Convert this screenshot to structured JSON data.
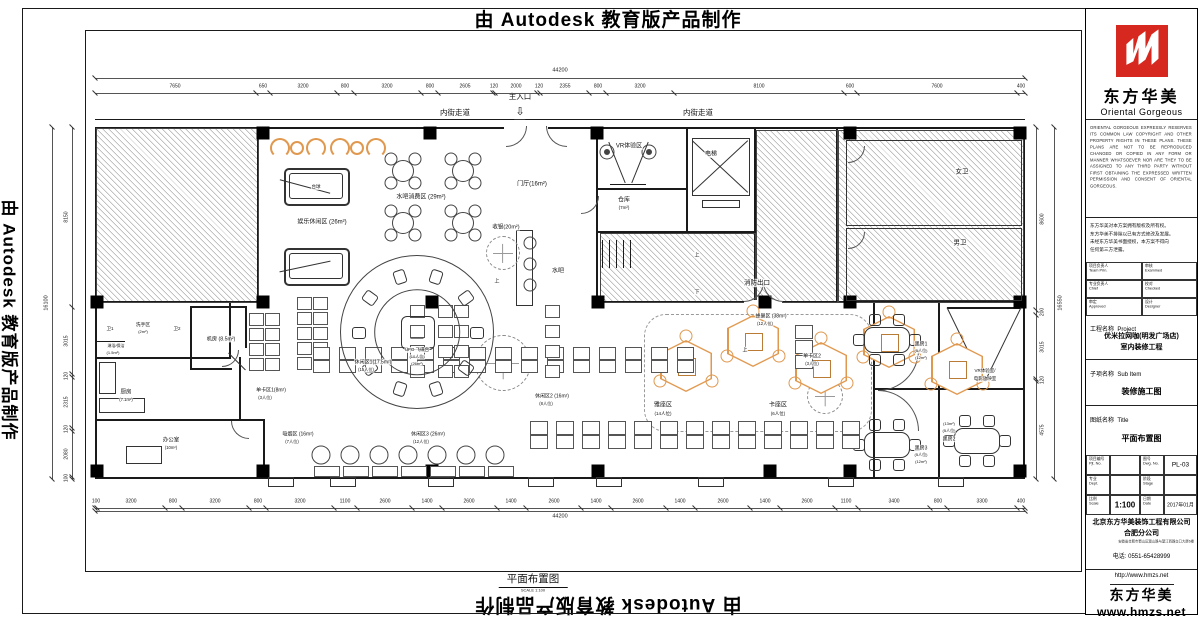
{
  "watermark": {
    "text": "由 Autodesk 教育版产品制作"
  },
  "sheet": {
    "footer_title": "平面布置图",
    "footer_scale": "SCALE  1:100"
  },
  "plan": {
    "labels": [
      [
        "内街走道",
        455,
        113,
        7.5
      ],
      [
        "主入口",
        520,
        97,
        7.5
      ],
      [
        "内街走道",
        698,
        113,
        7.5
      ],
      [
        "⇩",
        520,
        112,
        11
      ],
      [
        "娱乐休闲区 (26m²)",
        322,
        222,
        6
      ],
      [
        "台球",
        316,
        187,
        4.5
      ],
      [
        "水吧消费区 (29m²)",
        421,
        197,
        6
      ],
      [
        "门厅(16m²)",
        532,
        184,
        6
      ],
      [
        "VR体验区",
        629,
        146,
        6
      ],
      [
        "仓库",
        624,
        200,
        6
      ],
      [
        "(7m²)",
        624,
        208,
        4.5
      ],
      [
        "电梯",
        711,
        154,
        6
      ],
      [
        "女卫",
        962,
        172,
        6.5
      ],
      [
        "男卫",
        960,
        243,
        6.5
      ],
      [
        "消防出口",
        757,
        283,
        6.5
      ],
      [
        "收银(20m²)",
        506,
        227,
        5.5
      ],
      [
        "水吧",
        558,
        271,
        6
      ],
      [
        "机房 (8.5m²)",
        221,
        339,
        5.2
      ],
      [
        "洗手区",
        143,
        325,
        4.8
      ],
      [
        "(2m²)",
        143,
        332,
        4
      ],
      [
        "卫1",
        110,
        329,
        4.5
      ],
      [
        "卫2",
        177,
        329,
        4.5
      ],
      [
        "淋浴/保洁",
        116,
        346,
        4
      ],
      [
        "(1.5m²)",
        113,
        353,
        4
      ],
      [
        "厨房",
        126,
        392,
        5.5
      ],
      [
        "(7.1m²)",
        126,
        400,
        4.2
      ],
      [
        "办公室",
        171,
        440,
        5.5
      ],
      [
        "(10m²)",
        171,
        448,
        4.2
      ],
      [
        "单卡区1(8m²)",
        271,
        390,
        5
      ],
      [
        "(3人位)",
        265,
        398,
        4.2
      ],
      [
        "吸烟区 (16m²)",
        298,
        434,
        5
      ],
      [
        "(7人位)",
        292,
        442,
        4.2
      ],
      [
        "休闲区1(17.5m²)",
        373,
        362,
        5
      ],
      [
        "(15人位)",
        366,
        370,
        4.2
      ],
      [
        "休闲区2 (16m²)",
        552,
        396,
        5
      ],
      [
        "(8人位)",
        546,
        404,
        4.2
      ],
      [
        "休闲区3 (26m²)",
        428,
        434,
        5
      ],
      [
        "(12人位)",
        421,
        442,
        4.2
      ],
      [
        "雅座区",
        663,
        405,
        6
      ],
      [
        "(14人位)",
        663,
        414,
        4.5
      ],
      [
        "蜂巢区 (38m²)",
        771,
        316,
        5
      ],
      [
        "(12人位)",
        765,
        324,
        4.2
      ],
      [
        "单卡区2",
        812,
        356,
        5
      ],
      [
        "(3人位)",
        812,
        364,
        4.2
      ],
      [
        "卡座区",
        778,
        405,
        6
      ],
      [
        "(6人位)",
        778,
        414,
        4.5
      ],
      [
        "黑房1",
        921,
        344,
        5
      ],
      [
        "(5人位)",
        921,
        351,
        4
      ],
      [
        "(12m²)",
        921,
        358,
        4
      ],
      [
        "黑房3",
        921,
        448,
        5
      ],
      [
        "(5人位)",
        921,
        455,
        4
      ],
      [
        "(12m²)",
        921,
        462,
        4
      ],
      [
        "(13m²)",
        949,
        424,
        4
      ],
      [
        "(5人位)",
        949,
        431,
        4
      ],
      [
        "黑房2",
        949,
        439,
        5
      ],
      [
        "VR体验室/",
        985,
        371,
        4.5
      ],
      [
        "电影放映室",
        985,
        379,
        4.5
      ],
      [
        "UFO 飞碟台",
        417,
        350,
        4.5
      ],
      [
        "(10人位)",
        417,
        357,
        4
      ],
      [
        "(26m²)",
        417,
        364,
        4
      ],
      [
        "上",
        497,
        281,
        5
      ],
      [
        "上",
        697,
        255,
        5
      ],
      [
        "下",
        697,
        292,
        5
      ],
      [
        "上",
        745,
        350,
        5
      ]
    ],
    "dims": {
      "top": {
        "total": "44200",
        "segments": [
          7650,
          650,
          3200,
          800,
          3200,
          800,
          2605,
          120,
          2000,
          120,
          2355,
          800,
          3200,
          8100,
          600,
          7600,
          400
        ]
      },
      "bottom": {
        "total": "44200",
        "segments": [
          100,
          3200,
          800,
          3200,
          800,
          3200,
          1100,
          2600,
          1400,
          2600,
          1400,
          2600,
          1400,
          2600,
          1400,
          2600,
          1400,
          2600,
          1100,
          3400,
          800,
          3300,
          400
        ]
      },
      "left": {
        "total": "16100",
        "segments": [
          8150,
          3015,
          120,
          2315,
          120,
          2080,
          100
        ]
      },
      "right": {
        "total": "16550",
        "segments": [
          8600,
          200,
          3015,
          120,
          4575
        ]
      }
    },
    "walls": [
      [
        95,
        119,
        930,
        1
      ],
      [
        95,
        127,
        930,
        2
      ],
      [
        95,
        477,
        930,
        2
      ],
      [
        95,
        127,
        2,
        352
      ],
      [
        1023,
        127,
        2,
        352
      ],
      [
        257,
        127,
        2,
        175
      ],
      [
        95,
        301,
        170,
        2
      ],
      [
        95,
        357,
        136,
        2
      ],
      [
        95,
        419,
        170,
        2
      ],
      [
        229,
        301,
        2,
        57
      ],
      [
        239,
        357,
        2,
        62
      ],
      [
        263,
        419,
        2,
        60
      ],
      [
        190,
        306,
        57,
        2
      ],
      [
        190,
        306,
        2,
        64
      ],
      [
        190,
        368,
        42,
        2
      ],
      [
        245,
        306,
        2,
        42
      ],
      [
        596,
        127,
        2,
        178
      ],
      [
        598,
        188,
        90,
        2
      ],
      [
        598,
        231,
        156,
        2
      ],
      [
        686,
        127,
        2,
        104
      ],
      [
        754,
        129,
        2,
        172
      ],
      [
        836,
        129,
        2,
        172
      ],
      [
        598,
        301,
        148,
        2
      ],
      [
        782,
        301,
        241,
        2
      ],
      [
        873,
        303,
        2,
        174
      ],
      [
        938,
        303,
        2,
        174
      ],
      [
        875,
        388,
        148,
        2
      ],
      [
        947,
        307,
        74,
        2
      ],
      [
        602,
        240,
        1,
        28
      ],
      [
        609,
        240,
        1,
        28
      ],
      [
        616,
        240,
        1,
        28
      ],
      [
        623,
        240,
        1,
        28
      ],
      [
        630,
        240,
        1,
        28
      ],
      [
        95,
        341,
        30,
        1
      ],
      [
        610,
        184,
        36,
        1
      ]
    ],
    "white_rects": [
      [
        504,
        124,
        44,
        6
      ],
      [
        744,
        300,
        38,
        4
      ]
    ],
    "hatches": [
      [
        96,
        128,
        161,
        173
      ],
      [
        756,
        130,
        80,
        171
      ],
      [
        838,
        130,
        184,
        171
      ],
      [
        600,
        233,
        154,
        68
      ]
    ],
    "columns": [
      [
        263,
        133
      ],
      [
        430,
        133
      ],
      [
        597,
        133
      ],
      [
        850,
        133
      ],
      [
        1020,
        133
      ],
      [
        97,
        302
      ],
      [
        263,
        302
      ],
      [
        432,
        302
      ],
      [
        598,
        302
      ],
      [
        765,
        302
      ],
      [
        850,
        302
      ],
      [
        1020,
        302
      ],
      [
        97,
        471
      ],
      [
        263,
        471
      ],
      [
        432,
        471
      ],
      [
        598,
        471
      ],
      [
        770,
        471
      ],
      [
        850,
        471
      ],
      [
        1020,
        471
      ],
      [
        417,
        332
      ]
    ],
    "boxes": [
      [
        692,
        138,
        56,
        56
      ],
      [
        702,
        200,
        36,
        6
      ],
      [
        846,
        140,
        174,
        84
      ],
      [
        846,
        228,
        174,
        71
      ],
      [
        516,
        230,
        15,
        74
      ],
      [
        99,
        362,
        15,
        30
      ],
      [
        99,
        398,
        44,
        13
      ],
      [
        126,
        446,
        34,
        16
      ],
      [
        268,
        477,
        24,
        8
      ],
      [
        330,
        477,
        24,
        8
      ],
      [
        428,
        477,
        24,
        8
      ],
      [
        528,
        477,
        24,
        8
      ],
      [
        596,
        477,
        24,
        8
      ],
      [
        698,
        477,
        24,
        8
      ],
      [
        828,
        477,
        24,
        8
      ],
      [
        938,
        477,
        24,
        8
      ]
    ],
    "doors": [
      [
        506,
        126,
        20,
        "br"
      ],
      [
        546,
        126,
        20,
        "bl"
      ],
      [
        744,
        282,
        19,
        "br"
      ],
      [
        763,
        282,
        19,
        "bl"
      ],
      [
        581,
        196,
        17,
        "br"
      ],
      [
        222,
        350,
        16,
        "br"
      ],
      [
        231,
        421,
        17,
        "bl"
      ],
      [
        848,
        146,
        16,
        "br"
      ],
      [
        848,
        232,
        16,
        "br"
      ],
      [
        878,
        350,
        40,
        "br"
      ],
      [
        878,
        390,
        40,
        "tr"
      ]
    ],
    "diags": [
      [
        720,
        166,
        76,
        43
      ],
      [
        720,
        166,
        76,
        -43
      ],
      [
        617,
        162,
        44,
        68
      ],
      [
        640,
        162,
        44,
        -68
      ],
      [
        965,
        344,
        82,
        64
      ],
      [
        1003,
        344,
        82,
        -64
      ],
      [
        305,
        186,
        52,
        15
      ],
      [
        305,
        266,
        52,
        -12
      ],
      [
        237,
        361,
        24,
        45
      ]
    ],
    "dashed_circles": [
      [
        503,
        253,
        16
      ],
      [
        503,
        363,
        27
      ],
      [
        825,
        396,
        17
      ]
    ],
    "dashed_rect": [
      644,
      314,
      226,
      116
    ],
    "pool_tables": [
      [
        284,
        168
      ],
      [
        284,
        248
      ]
    ],
    "round_tables": [
      [
        403,
        171
      ],
      [
        463,
        171
      ],
      [
        403,
        223
      ],
      [
        463,
        223
      ]
    ],
    "hexpods": [
      [
        686,
        366
      ],
      [
        753,
        341
      ],
      [
        821,
        368
      ],
      [
        889,
        342
      ],
      [
        957,
        369
      ]
    ],
    "dark_tables": [
      [
        886,
        339
      ],
      [
        886,
        444
      ],
      [
        976,
        440
      ]
    ],
    "stools": [
      [
        530,
        243
      ],
      [
        530,
        264
      ],
      [
        530,
        285
      ]
    ],
    "lounge_chairs": [
      [
        321,
        455
      ],
      [
        350,
        455
      ],
      [
        379,
        455
      ],
      [
        408,
        455
      ],
      [
        437,
        455
      ],
      [
        466,
        455
      ],
      [
        495,
        455
      ]
    ],
    "vr_circles": [
      [
        607,
        152
      ],
      [
        649,
        152
      ]
    ],
    "sofa_groups": [
      270,
      330
    ],
    "desk_groups": [
      [
        249,
        313,
        4,
        2,
        13,
        11,
        16,
        15
      ],
      [
        297,
        297,
        5,
        2,
        13,
        11,
        16,
        15
      ],
      [
        313,
        347,
        2,
        15,
        15,
        11,
        26,
        13
      ],
      [
        410,
        305,
        4,
        1,
        13,
        11,
        0,
        20
      ],
      [
        438,
        305,
        4,
        2,
        13,
        11,
        16,
        20
      ],
      [
        545,
        305,
        4,
        1,
        13,
        11,
        0,
        20
      ],
      [
        530,
        421,
        2,
        13,
        16,
        12,
        26,
        14
      ],
      [
        314,
        466,
        1,
        7,
        24,
        9,
        29,
        0
      ],
      [
        795,
        325,
        3,
        1,
        16,
        12,
        0,
        15
      ]
    ],
    "ufo": {
      "cx": 417,
      "cy": 332,
      "r": 76
    }
  },
  "titleblock": {
    "brand_cn": "东方华美",
    "brand_en": "Oriental  Gorgeous",
    "copyright_en": "ORIENTAL GORGEOUS EXPRESSLY RESERVES ITS COMMON LAW COPYRIGHT AND OTHER PROPERTY RIGHTS IN THESE PLANS. THESE PLANS ARE NOT TO BE REPRODUCED CHANGED OR COPIED IN ANY FORM OR MANNER WHATSOEVER NOR ARE THEY TO BE ASSIGNED TO ANY THIRD PARTY WITHOUT FIRST OBTAINING THE EXPRESSED WRITTEN PERMISSION AND CONSENT OF ORIENTAL GORGEOUS.",
    "copyright_cn": "东方华美对本方案拥有版权及所有权。\n东方华美不排除以已有方式修改及发展。\n未经东方华美书面授权，本方案不得向\n任何第三方泄露。",
    "roles": [
      {
        "cn": "项目负责人",
        "en": "Team Prin."
      },
      {
        "cn": "审核",
        "en": "Examined"
      },
      {
        "cn": "专业负责人",
        "en": "Chief"
      },
      {
        "cn": "校对",
        "en": "Checked"
      },
      {
        "cn": "审定",
        "en": "Approved"
      },
      {
        "cn": "设计",
        "en": "Designer"
      }
    ],
    "project_label": "工程名称",
    "project_label_en": "Project",
    "project_name": "优米拉网咖(明发广场店)\n室内装修工程",
    "subitem_label": "子项名称",
    "subitem_label_en": "Sub Item",
    "subitem_name": "装修施工图",
    "sheet_label": "图纸名称",
    "sheet_label_en": "Title",
    "sheet_name": "平面布置图",
    "fields": {
      "pjt_cn": "项目编号",
      "pjt_en": "Pjt. No.",
      "dwg_cn": "图号",
      "dwg_en": "Dwg. No.",
      "dwg_no": "PL-03",
      "dept_cn": "专业",
      "dept_en": "Dept.",
      "stage_cn": "阶段",
      "stage_en": "Stage",
      "scale_cn": "比例",
      "scale_en": "Scale",
      "scale_val": "1:100",
      "date_cn": "日期",
      "date_en": "Date",
      "date_val": "2017年01月"
    },
    "company": "北京东方华美装饰工程有限公司\n合肥分公司",
    "address": "安徽省合肥市蜀山区潜山路与望江西路交口大厦6楼",
    "phone": "电话: 0551-65428999",
    "url": "http://www.hmzs.net",
    "stamp_cn": "东方华美",
    "stamp_url": "www.hmzs.net",
    "logo_color": "#d6281e"
  }
}
